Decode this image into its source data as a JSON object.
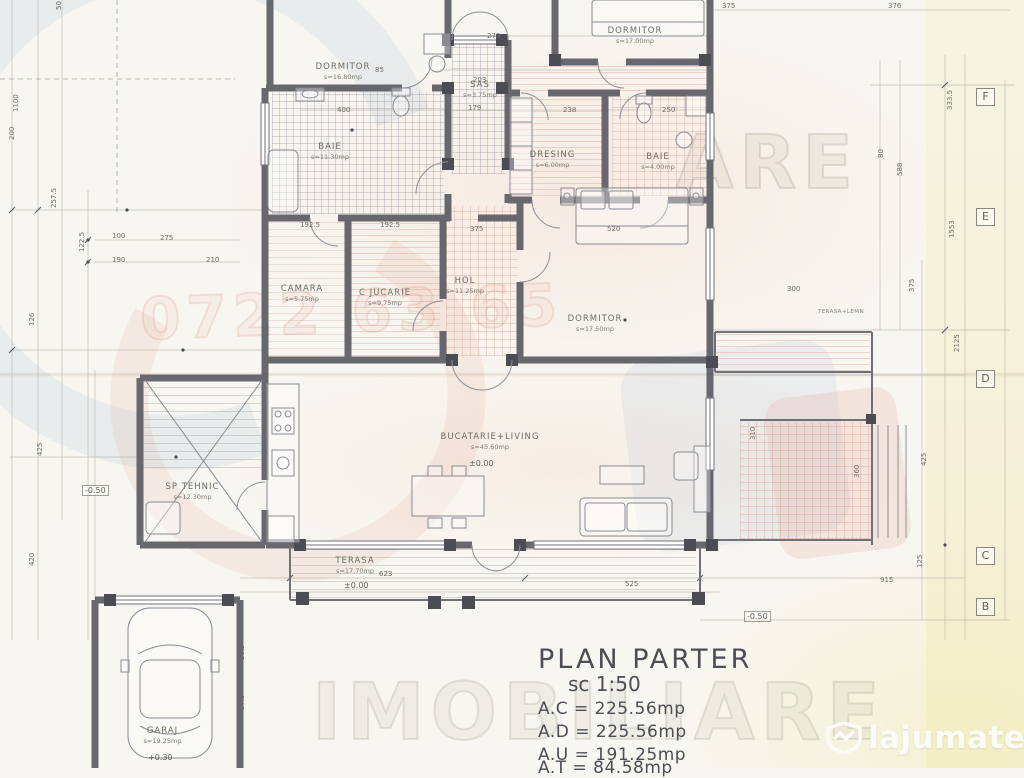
{
  "title_block": {
    "title": "PLAN PARTER",
    "scale": "sc 1:50",
    "area_lines": [
      "A.C = 225.56mp",
      "A.D = 225.56mp",
      "A.U = 191.25mp"
    ],
    "area_line_partial": "A.T = 84.58mp"
  },
  "rooms": [
    {
      "name": "DORMITOR",
      "area": "s=16.80mp",
      "x": 268,
      "y": 62,
      "w": 150
    },
    {
      "name": "SAS",
      "area": "s=3.75mp",
      "x": 430,
      "y": 80,
      "w": 100
    },
    {
      "name": "DORMITOR",
      "area": "s=17.00mp",
      "x": 570,
      "y": 26,
      "w": 130
    },
    {
      "name": "BAIE",
      "area": "s=11.30mp",
      "x": 270,
      "y": 142,
      "w": 120
    },
    {
      "name": "DRESING",
      "area": "s=6.00mp",
      "x": 505,
      "y": 150,
      "w": 95
    },
    {
      "name": "BAIE",
      "area": "s=4.00mp",
      "x": 612,
      "y": 152,
      "w": 92
    },
    {
      "name": "CAMARA",
      "area": "s=5.75mp",
      "x": 258,
      "y": 284,
      "w": 88
    },
    {
      "name": "C JUCARIE",
      "area": "s=9.75mp",
      "x": 330,
      "y": 288,
      "w": 110
    },
    {
      "name": "HOL",
      "area": "s=11.25mp",
      "x": 420,
      "y": 276,
      "w": 90
    },
    {
      "name": "DORMITOR",
      "area": "s=17.50mp",
      "x": 540,
      "y": 314,
      "w": 110
    },
    {
      "name": "BUCATARIE+LIVING",
      "area": "s=45.60mp",
      "x": 400,
      "y": 432,
      "w": 180
    },
    {
      "name": "SP TEHNIC",
      "area": "s=12.30mp",
      "x": 130,
      "y": 482,
      "w": 125
    },
    {
      "name": "TERASA",
      "area": "s=17.70mp",
      "x": 300,
      "y": 556,
      "w": 110
    },
    {
      "name": "GARAJ",
      "area": "s=19.25mp",
      "x": 110,
      "y": 726,
      "w": 105
    }
  ],
  "levels": [
    {
      "text": "±0.00",
      "x": 469,
      "y": 459,
      "boxed": false
    },
    {
      "text": "±0.00",
      "x": 344,
      "y": 581,
      "boxed": false
    },
    {
      "text": "-0.50",
      "x": 82,
      "y": 485,
      "boxed": true
    },
    {
      "text": "-0.50",
      "x": 744,
      "y": 611,
      "boxed": true
    },
    {
      "text": "+0.30",
      "x": 148,
      "y": 753,
      "boxed": false
    }
  ],
  "grid_letters": [
    {
      "label": "F",
      "x": 976,
      "y": 88
    },
    {
      "label": "E",
      "x": 976,
      "y": 208
    },
    {
      "label": "D",
      "x": 976,
      "y": 370
    },
    {
      "label": "C",
      "x": 976,
      "y": 547
    },
    {
      "label": "B",
      "x": 976,
      "y": 598
    }
  ],
  "annotations": [
    {
      "text": "TERASA+LEMN",
      "x": 818,
      "y": 309
    }
  ],
  "dimensions": [
    {
      "t": "50",
      "x": 55,
      "y": 10,
      "r": 1
    },
    {
      "t": "1100",
      "x": 12,
      "y": 112,
      "r": 1
    },
    {
      "t": "200",
      "x": 8,
      "y": 140,
      "r": 1
    },
    {
      "t": "257.5",
      "x": 50,
      "y": 208,
      "r": 1
    },
    {
      "t": "122.5",
      "x": 78,
      "y": 252,
      "r": 1
    },
    {
      "t": "126",
      "x": 28,
      "y": 326,
      "r": 1
    },
    {
      "t": "425",
      "x": 36,
      "y": 456,
      "r": 1
    },
    {
      "t": "420",
      "x": 28,
      "y": 566,
      "r": 1
    },
    {
      "t": "100",
      "x": 112,
      "y": 232,
      "r": 0
    },
    {
      "t": "190",
      "x": 112,
      "y": 256,
      "r": 0
    },
    {
      "t": "275",
      "x": 160,
      "y": 234,
      "r": 0
    },
    {
      "t": "210",
      "x": 206,
      "y": 256,
      "r": 0
    },
    {
      "t": "85",
      "x": 375,
      "y": 66,
      "r": 0
    },
    {
      "t": "279",
      "x": 487,
      "y": 32,
      "r": 0
    },
    {
      "t": "203",
      "x": 473,
      "y": 76,
      "r": 0
    },
    {
      "t": "179",
      "x": 468,
      "y": 104,
      "r": 0
    },
    {
      "t": "238",
      "x": 563,
      "y": 106,
      "r": 0
    },
    {
      "t": "250",
      "x": 662,
      "y": 106,
      "r": 0
    },
    {
      "t": "400",
      "x": 337,
      "y": 106,
      "r": 0
    },
    {
      "t": "192.5",
      "x": 300,
      "y": 221,
      "r": 0
    },
    {
      "t": "192.5",
      "x": 380,
      "y": 221,
      "r": 0
    },
    {
      "t": "375",
      "x": 470,
      "y": 225,
      "r": 0
    },
    {
      "t": "520",
      "x": 607,
      "y": 225,
      "r": 0
    },
    {
      "t": "300",
      "x": 787,
      "y": 285,
      "r": 0
    },
    {
      "t": "375",
      "x": 722,
      "y": 2,
      "r": 0
    },
    {
      "t": "376",
      "x": 888,
      "y": 2,
      "r": 0
    },
    {
      "t": "310",
      "x": 749,
      "y": 440,
      "r": 1
    },
    {
      "t": "333.5",
      "x": 946,
      "y": 110,
      "r": 1
    },
    {
      "t": "80",
      "x": 877,
      "y": 158,
      "r": 1
    },
    {
      "t": "588",
      "x": 896,
      "y": 176,
      "r": 1
    },
    {
      "t": "1553",
      "x": 948,
      "y": 238,
      "r": 1
    },
    {
      "t": "375",
      "x": 908,
      "y": 292,
      "r": 1
    },
    {
      "t": "2125",
      "x": 953,
      "y": 352,
      "r": 1
    },
    {
      "t": "425",
      "x": 920,
      "y": 466,
      "r": 1
    },
    {
      "t": "360",
      "x": 853,
      "y": 478,
      "r": 1
    },
    {
      "t": "125",
      "x": 916,
      "y": 568,
      "r": 1
    },
    {
      "t": "915",
      "x": 880,
      "y": 576,
      "r": 0
    },
    {
      "t": "623",
      "x": 379,
      "y": 570,
      "r": 0
    },
    {
      "t": "525",
      "x": 625,
      "y": 580,
      "r": 0
    },
    {
      "t": "97.5",
      "x": 238,
      "y": 710,
      "r": 1
    },
    {
      "t": "58.5",
      "x": 238,
      "y": 660,
      "r": 1
    }
  ],
  "watermarks": {
    "phone": "0722 63 65",
    "agency_fragment": "ARE",
    "agency_name": "IMOBILIARE",
    "site_name": "lajumate",
    "site_tld": ".ro"
  }
}
